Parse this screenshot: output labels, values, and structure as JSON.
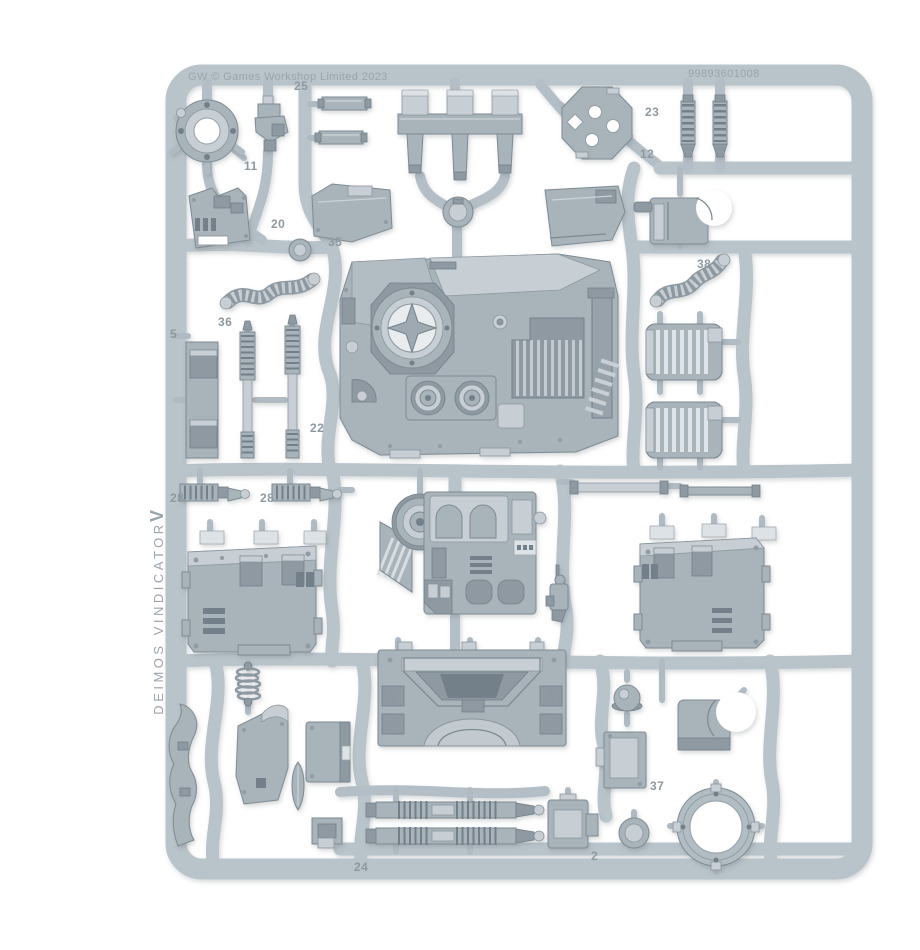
{
  "photo": {
    "subject": "Grey plastic model-kit sprue photographed on a white background",
    "copyright_text": "GW © Games Workshop Limited 2023",
    "product_code": "99893601008",
    "vertical_kit_label": "DEIMOS VINDICATOR",
    "vertical_mark": "V",
    "colors": {
      "background": "#ffffff",
      "sprue_runner": "#b9c3ca",
      "part_base": "#a9b3ba",
      "part_highlight": "#c7ced4",
      "part_shadow": "#8e99a1",
      "embossed_text": "#8d98a0"
    }
  },
  "part_labels": [
    "25",
    "23",
    "12",
    "38",
    "11",
    "20",
    "35",
    "5",
    "36",
    "22",
    "28",
    "28",
    "24",
    "2",
    "37"
  ]
}
